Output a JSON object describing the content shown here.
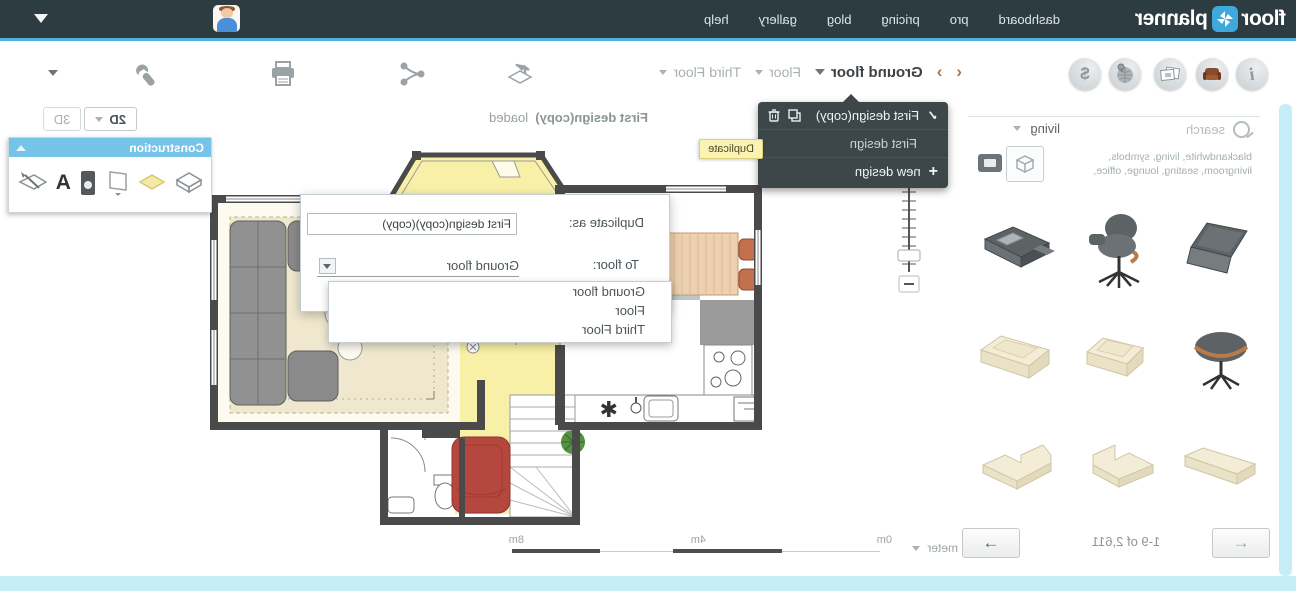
{
  "header": {
    "logo_floor": "floor",
    "logo_planner": "planner",
    "nav": [
      {
        "label": "dashboard"
      },
      {
        "label": "pro"
      },
      {
        "label": "pricing"
      },
      {
        "label": "blog"
      },
      {
        "label": "gallery"
      },
      {
        "label": "help"
      }
    ]
  },
  "toolbar": {
    "floors": {
      "current": "Ground floor",
      "floor2": "Floor",
      "floor3": "Third Floor"
    },
    "status_name": "First design(copy)",
    "status_suffix": "loaded",
    "view_2d": "2D",
    "view_3d": "3D"
  },
  "floors_menu": {
    "item1": "First design(copy)",
    "item2": "First design",
    "item3": "new design",
    "tooltip": "Duplicate"
  },
  "duplicate_dialog": {
    "name_label": "Duplicate as:",
    "name_value": "First design(copy)(copy)",
    "floor_label": "To floor:",
    "floor_value": "Ground floor",
    "options": [
      "Ground floor",
      "Floor",
      "Third Floor"
    ]
  },
  "construction_panel": {
    "title": "Construction"
  },
  "library": {
    "search_placeholder": "search",
    "category": "living",
    "tags_line1": "blackandwhite, living, symbols,",
    "tags_line2": "livingroom, seating, lounge, office,",
    "pagination": "1-9 of 2,611"
  },
  "scale_bar": {
    "unit": "meter",
    "tick0": "0m",
    "tick4": "4m",
    "tick8": "8m"
  },
  "colors": {
    "accent_blue": "#4fb3e0",
    "header_bg": "#2d3c40",
    "construction_header": "#76c3e9",
    "tooltip_bg": "#fbf3b4",
    "plan_yellow": "#f8f0a6",
    "plan_red": "#b5473e",
    "scrollbar_cyan": "#c6eef8"
  }
}
